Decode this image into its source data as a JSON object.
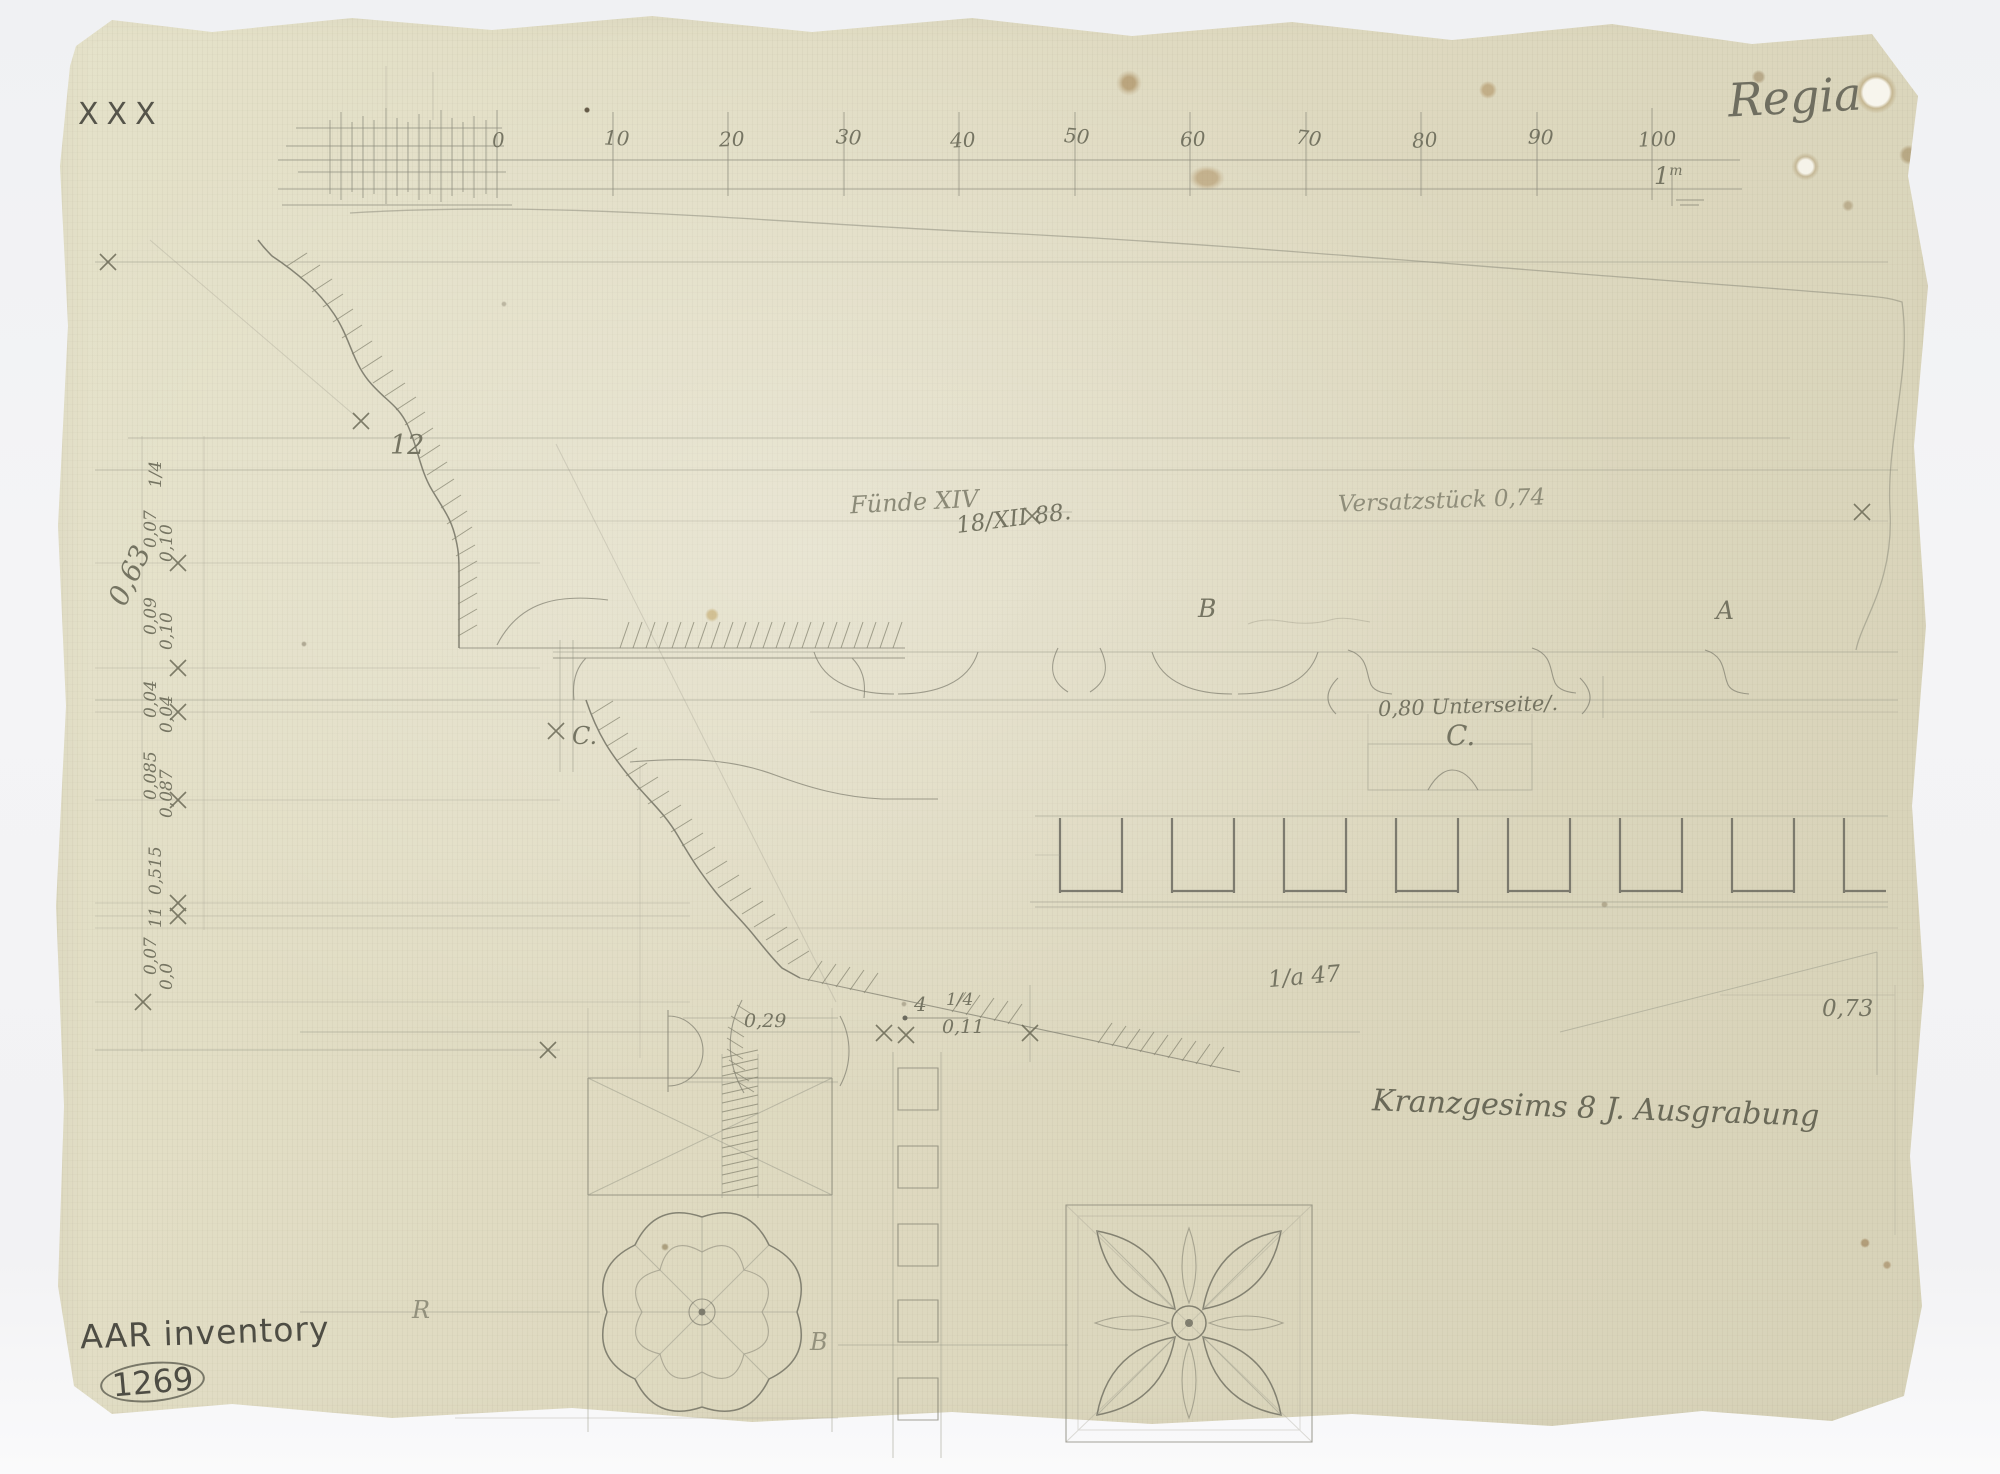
{
  "colors": {
    "paper": "#dfdac1",
    "background": "#eef0f2",
    "pencil": "#83826f",
    "pencil_dark": "#56554a"
  },
  "sheet": {
    "corner_mark": "XXX",
    "title": "Regia",
    "inventory_label": "AAR inventory",
    "inventory_number": "1269"
  },
  "scale_bar": {
    "ticks": [
      "0",
      "10",
      "20",
      "30",
      "40",
      "50",
      "60",
      "70",
      "80",
      "90",
      "100"
    ],
    "unit_value": "1",
    "unit_sup": "m"
  },
  "annotations": {
    "num_12": "12",
    "find_note": "Fünde XIV",
    "date": "18/XII 88.",
    "versatz_note": "Versatzstück 0,74",
    "label_b": "B",
    "label_a": "A",
    "unterseite_note": "0,80 Unterseite/.",
    "label_c_right": "C.",
    "label_c_left": "C.",
    "ratio_note": "1/a 47",
    "dim_073": "0,73",
    "caption": "Kranzgesims 8 J. Ausgrabung",
    "dim_029": "0,29",
    "dim_4": "4",
    "dim_quarter": "1/4",
    "dim_011": "0,11",
    "label_r": "R",
    "label_b2": "B"
  },
  "margin_dims": [
    "1/4",
    "0,07",
    "0,10",
    "0,09",
    "0,10",
    "0,04",
    "0,04",
    "0,085",
    "0,087",
    "0,515",
    "11",
    "0,07",
    "0,0"
  ],
  "margin_dim_large": "0,63"
}
